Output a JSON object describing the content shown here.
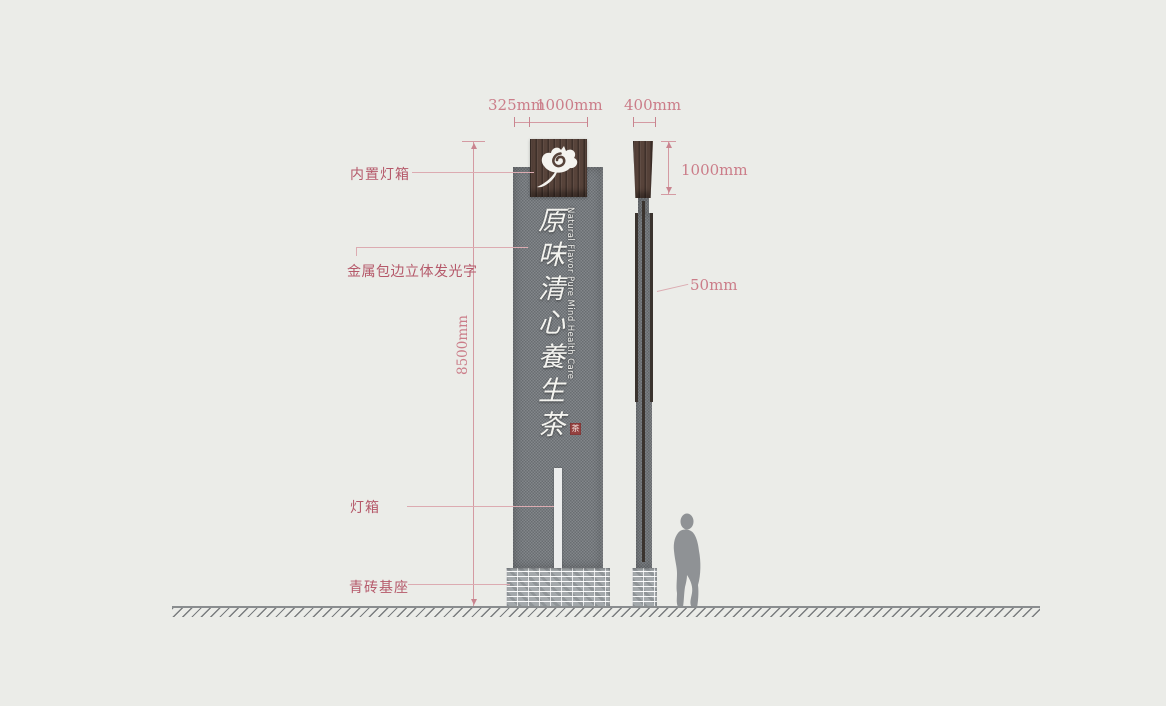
{
  "drawing": {
    "title": "signage pylon elevation drawing",
    "sign": {
      "chinese_name": "原味清心養生茶",
      "english_name": "Natural Flavor Pure Mind Health Care",
      "seal_char": "茶"
    },
    "dimensions": {
      "front_offset": "325mm",
      "front_logo_width": "1000mm",
      "side_width": "400mm",
      "side_logo_height": "1000mm",
      "total_height": "8500mm",
      "letter_depth": "50mm"
    },
    "labels": {
      "built_in_lightbox": "内置灯箱",
      "metal_edge_letters": "金属包边立体发光字",
      "lightbox": "灯箱",
      "brick_base": "青砖基座"
    },
    "colors": {
      "background": "#ebece8",
      "dimension_pink": "#cb7d89",
      "label_red": "#b5596a",
      "stone_gray": "#75797e",
      "wood_brown": "#57433a",
      "brick_gray": "#a3a8ab",
      "seal_red": "#944140",
      "figure_gray": "#8f9295"
    }
  }
}
